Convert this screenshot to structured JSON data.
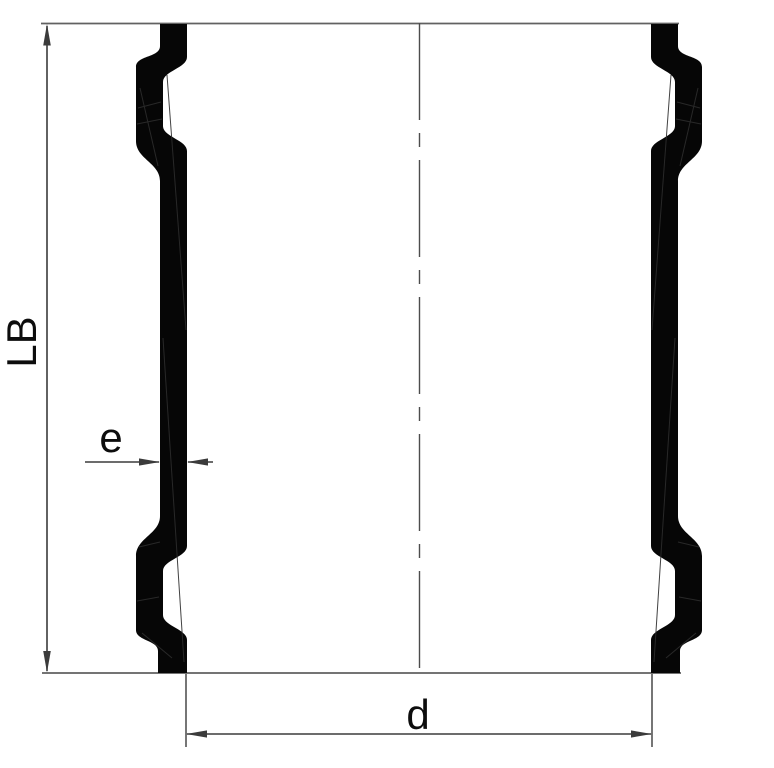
{
  "diagram": {
    "type": "pipe-coupling-cross-section",
    "labels": {
      "length": "LB",
      "wall_thickness": "e",
      "inner_diameter": "d"
    },
    "colors": {
      "background": "#ffffff",
      "wall_fill": "#060606",
      "dimension_line": "#3b3b3b",
      "face_line": "#616161",
      "centerline": "#4c4c4c",
      "label_text": "#0d0d0d"
    }
  }
}
